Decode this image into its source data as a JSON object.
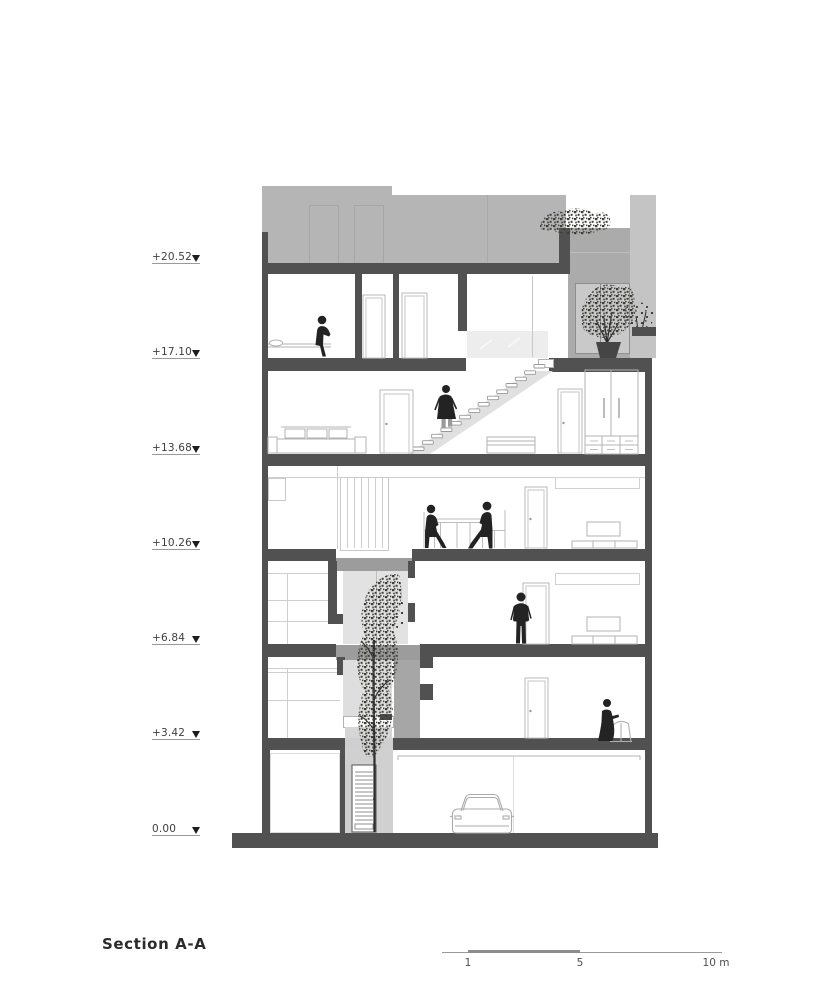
{
  "title": {
    "label": "Section A-A"
  },
  "elevation_markers": {
    "levels": [
      {
        "label": "+20.52"
      },
      {
        "label": "+17.10"
      },
      {
        "label": "+13.68"
      },
      {
        "label": "+10.26"
      },
      {
        "label": "+6.84"
      },
      {
        "label": "+3.42"
      },
      {
        "label": "0.00"
      }
    ]
  },
  "scale_bar": {
    "labels": [
      {
        "text": "1"
      },
      {
        "text": "5"
      },
      {
        "text": "10 m"
      }
    ]
  },
  "colors": {
    "wall": "#515151",
    "figure": "#232323",
    "foliage": "#3c3e39",
    "penthouse": "#b5b5b5"
  }
}
